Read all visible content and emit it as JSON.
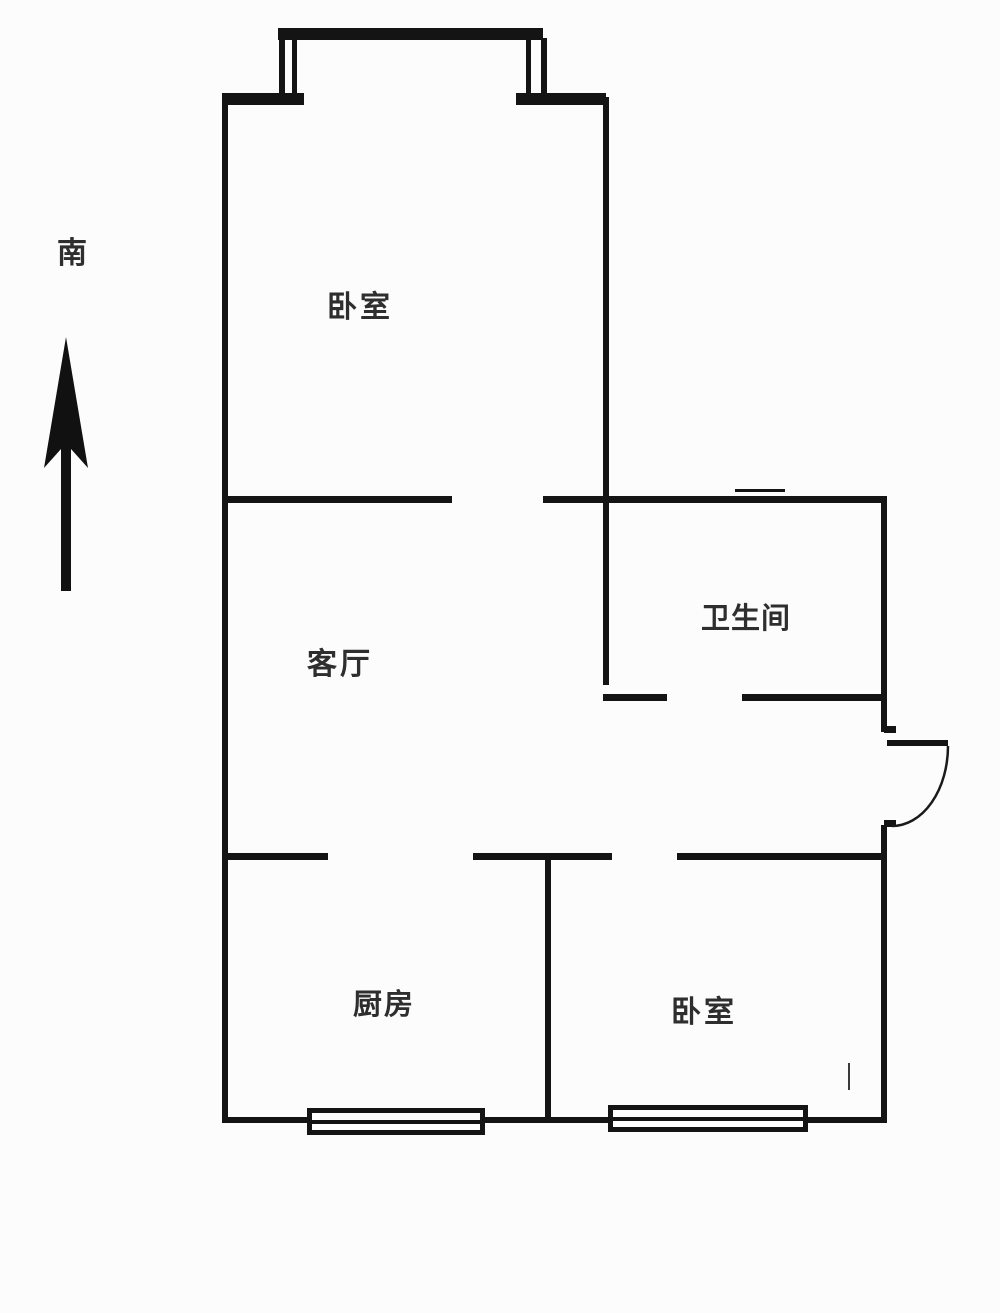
{
  "compass": {
    "label": "南"
  },
  "rooms": {
    "bedroom_top": "卧室",
    "living_room": "客厅",
    "bathroom": "卫生间",
    "kitchen": "厨房",
    "bedroom_bottom": "卧室"
  },
  "colors": {
    "wall": "#141414",
    "background": "#fcfcfc",
    "text": "#2e2e2e"
  }
}
